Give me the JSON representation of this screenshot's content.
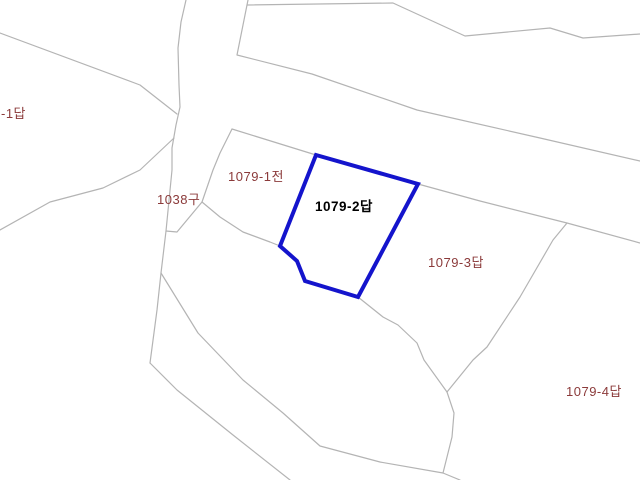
{
  "map": {
    "type": "cadastral-parcel-map",
    "colors": {
      "background": "#ffffff",
      "boundary_line": "#b4b4b4",
      "highlight_stroke": "#1414cc",
      "label_text": "#8b3a3a",
      "highlight_label_text": "#000000"
    },
    "labels": [
      {
        "text": "-1답",
        "x": 1,
        "y": 107,
        "style": "normal"
      },
      {
        "text": "1038구",
        "x": 157,
        "y": 193,
        "style": "normal"
      },
      {
        "text": "1079-1전",
        "x": 228,
        "y": 170,
        "style": "normal"
      },
      {
        "text": "1079-2답",
        "x": 315,
        "y": 200,
        "style": "highlight"
      },
      {
        "text": "1079-3답",
        "x": 428,
        "y": 256,
        "style": "normal"
      },
      {
        "text": "1079-4답",
        "x": 566,
        "y": 385,
        "style": "normal"
      }
    ],
    "highlighted_parcel": {
      "label": "1079-2답",
      "points": [
        [
          316,
          155
        ],
        [
          418,
          184
        ],
        [
          358,
          297
        ],
        [
          305,
          281
        ],
        [
          297,
          261
        ],
        [
          280,
          246
        ]
      ]
    },
    "boundary_lines": [
      {
        "name": "diagonal-upper-left",
        "points": [
          [
            0,
            33
          ],
          [
            140,
            85
          ],
          [
            177,
            114
          ]
        ]
      },
      {
        "name": "stream-upper",
        "points": [
          [
            186,
            0
          ],
          [
            181,
            22
          ],
          [
            178,
            48
          ],
          [
            179,
            85
          ],
          [
            180,
            107
          ],
          [
            176,
            125
          ],
          [
            172,
            148
          ],
          [
            172,
            170
          ],
          [
            166,
            231
          ],
          [
            161,
            273
          ],
          [
            157,
            310
          ],
          [
            150,
            363
          ]
        ]
      },
      {
        "name": "stream-lower",
        "points": [
          [
            150,
            363
          ],
          [
            177,
            390
          ],
          [
            233,
            435
          ],
          [
            290,
            480
          ]
        ]
      },
      {
        "name": "branch-southeast",
        "points": [
          [
            161,
            273
          ],
          [
            198,
            333
          ],
          [
            243,
            380
          ],
          [
            283,
            413
          ],
          [
            320,
            446
          ],
          [
            380,
            462
          ],
          [
            443,
            473
          ]
        ]
      },
      {
        "name": "left-curve",
        "points": [
          [
            0,
            230
          ],
          [
            50,
            202
          ],
          [
            103,
            188
          ],
          [
            140,
            170
          ],
          [
            174,
            138
          ]
        ]
      },
      {
        "name": "parcel-1079-1-west-edge",
        "points": [
          [
            232,
            129
          ],
          [
            220,
            153
          ],
          [
            213,
            170
          ],
          [
            202,
            202
          ]
        ]
      },
      {
        "name": "ditch-wedge-bottom",
        "points": [
          [
            202,
            202
          ],
          [
            177,
            232
          ],
          [
            166,
            231
          ]
        ]
      },
      {
        "name": "edge-to-blue-west-vertex",
        "points": [
          [
            202,
            202
          ],
          [
            220,
            217
          ],
          [
            243,
            232
          ],
          [
            270,
            242
          ],
          [
            280,
            246
          ]
        ]
      },
      {
        "name": "parcel-1079-1-east-edge",
        "points": [
          [
            232,
            129
          ],
          [
            316,
            155
          ]
        ]
      },
      {
        "name": "road-lower-edge",
        "points": [
          [
            248,
            0
          ],
          [
            237,
            55
          ],
          [
            312,
            74
          ],
          [
            417,
            110
          ],
          [
            540,
            138
          ],
          [
            640,
            161
          ]
        ]
      },
      {
        "name": "road-upper-edge",
        "points": [
          [
            247,
            5
          ],
          [
            393,
            3
          ],
          [
            465,
            36
          ],
          [
            550,
            28
          ],
          [
            583,
            38
          ],
          [
            640,
            34
          ]
        ]
      },
      {
        "name": "boundary-east-from-blue",
        "points": [
          [
            418,
            184
          ],
          [
            480,
            201
          ],
          [
            567,
            223
          ],
          [
            640,
            243
          ]
        ]
      },
      {
        "name": "boundary-1079-3-4",
        "points": [
          [
            567,
            223
          ],
          [
            553,
            240
          ],
          [
            520,
            297
          ],
          [
            487,
            347
          ],
          [
            473,
            360
          ],
          [
            447,
            392
          ]
        ]
      },
      {
        "name": "boundary-south",
        "points": [
          [
            447,
            392
          ],
          [
            454,
            413
          ],
          [
            452,
            437
          ],
          [
            443,
            473
          ],
          [
            460,
            480
          ]
        ]
      },
      {
        "name": "from-blue-bottom-vertex",
        "points": [
          [
            358,
            297
          ],
          [
            383,
            317
          ],
          [
            398,
            325
          ],
          [
            417,
            343
          ],
          [
            424,
            360
          ],
          [
            447,
            392
          ]
        ]
      }
    ]
  }
}
